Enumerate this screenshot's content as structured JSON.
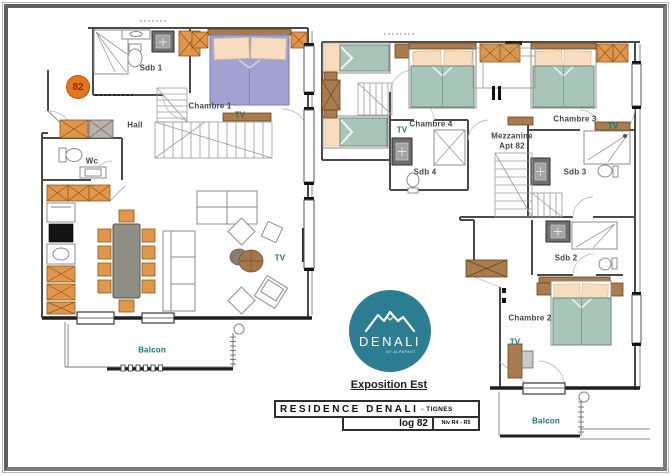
{
  "sheet": {
    "badge": {
      "number": "82"
    },
    "logo": {
      "name": "DENALI",
      "byline": "BY ALPAPART"
    },
    "exposition_label": "Exposition Est",
    "title_block": {
      "residence": "RESIDENCE DENALI",
      "location": "- TIGNES",
      "unit": "log 82",
      "level": "Niv R4 - R5"
    }
  },
  "floor_lower": {
    "labels": {
      "sdb1": "Sdb 1",
      "chambre1": "Chambre 1",
      "tv_chambre1": "TV",
      "hall": "Hall",
      "wc": "Wc",
      "tv_living": "TV",
      "balcon": "Balcon"
    }
  },
  "floor_upper": {
    "labels": {
      "tv_chambre4": "TV",
      "chambre4": "Chambre 4",
      "mezzanine_line1": "Mezzanine",
      "mezzanine_line2": "Apt 82",
      "chambre3": "Chambre 3",
      "tv_chambre3": "TV",
      "sdb4": "Sdb 4",
      "sdb3": "Sdb 3",
      "sdb2": "Sdb 2",
      "chambre2": "Chambre 2",
      "tv_chambre2": "TV",
      "balcon": "Balcon"
    }
  },
  "colors": {
    "wall": "#4a4a4a",
    "wood": "#a97c4f",
    "cabinet_orange": "#e1964c",
    "bed_green": "#a8c5ba",
    "bed_lavender": "#a2a2d2",
    "pillow": "#f7dcc0",
    "room_label": "#3f4b41",
    "accent_label": "#17777c",
    "logo_teal": "#2c7d92",
    "badge_orange": "#e5751e",
    "badge_text": "#8f2b00"
  }
}
